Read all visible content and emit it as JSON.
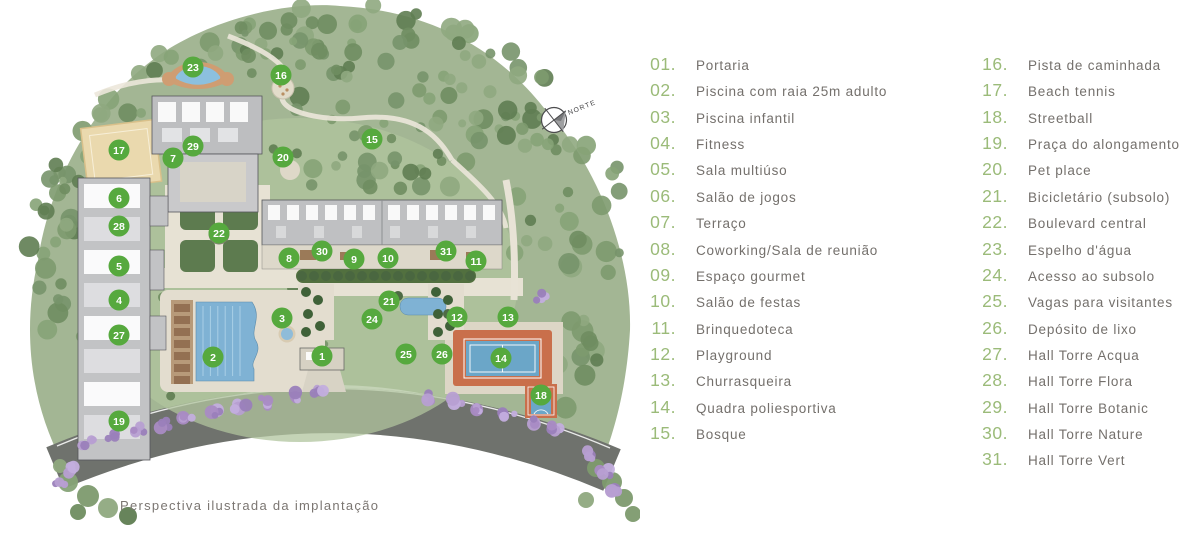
{
  "map": {
    "caption": "Perspectiva ilustrada da implantação",
    "compass_label": "NORTE",
    "marker_color": "#56a93e",
    "markers": [
      {
        "n": "1",
        "x": 322,
        "y": 356
      },
      {
        "n": "2",
        "x": 213,
        "y": 357
      },
      {
        "n": "3",
        "x": 282,
        "y": 318
      },
      {
        "n": "4",
        "x": 119,
        "y": 300
      },
      {
        "n": "5",
        "x": 119,
        "y": 266
      },
      {
        "n": "6",
        "x": 119,
        "y": 198
      },
      {
        "n": "7",
        "x": 173,
        "y": 158
      },
      {
        "n": "8",
        "x": 289,
        "y": 258
      },
      {
        "n": "9",
        "x": 354,
        "y": 259
      },
      {
        "n": "10",
        "x": 388,
        "y": 258
      },
      {
        "n": "11",
        "x": 476,
        "y": 261
      },
      {
        "n": "12",
        "x": 457,
        "y": 317
      },
      {
        "n": "13",
        "x": 508,
        "y": 317
      },
      {
        "n": "14",
        "x": 501,
        "y": 358
      },
      {
        "n": "15",
        "x": 372,
        "y": 139
      },
      {
        "n": "16",
        "x": 281,
        "y": 75
      },
      {
        "n": "17",
        "x": 119,
        "y": 150
      },
      {
        "n": "18",
        "x": 541,
        "y": 395
      },
      {
        "n": "19",
        "x": 119,
        "y": 421
      },
      {
        "n": "20",
        "x": 283,
        "y": 157
      },
      {
        "n": "21",
        "x": 389,
        "y": 301
      },
      {
        "n": "22",
        "x": 219,
        "y": 233
      },
      {
        "n": "23",
        "x": 193,
        "y": 67
      },
      {
        "n": "24",
        "x": 372,
        "y": 319
      },
      {
        "n": "25",
        "x": 406,
        "y": 354
      },
      {
        "n": "26",
        "x": 442,
        "y": 354
      },
      {
        "n": "27",
        "x": 119,
        "y": 335
      },
      {
        "n": "28",
        "x": 119,
        "y": 226
      },
      {
        "n": "29",
        "x": 193,
        "y": 146
      },
      {
        "n": "30",
        "x": 322,
        "y": 251
      },
      {
        "n": "31",
        "x": 446,
        "y": 251
      }
    ]
  },
  "legend": {
    "number_color": "#9bbb79",
    "text_color": "#74706c",
    "columns": [
      {
        "items": [
          {
            "num": "01.",
            "label": "Portaria"
          },
          {
            "num": "02.",
            "label": "Piscina com raia 25m adulto"
          },
          {
            "num": "03.",
            "label": "Piscina infantil"
          },
          {
            "num": "04.",
            "label": "Fitness"
          },
          {
            "num": "05.",
            "label": "Sala multiúso"
          },
          {
            "num": "06.",
            "label": "Salão de jogos"
          },
          {
            "num": "07.",
            "label": "Terraço"
          },
          {
            "num": "08.",
            "label": "Coworking/Sala de reunião"
          },
          {
            "num": "09.",
            "label": "Espaço gourmet"
          },
          {
            "num": "10.",
            "label": "Salão de festas"
          },
          {
            "num": "11.",
            "label": "Brinquedoteca"
          },
          {
            "num": "12.",
            "label": "Playground"
          },
          {
            "num": "13.",
            "label": "Churrasqueira"
          },
          {
            "num": "14.",
            "label": "Quadra poliesportiva"
          },
          {
            "num": "15.",
            "label": "Bosque"
          }
        ]
      },
      {
        "items": [
          {
            "num": "16.",
            "label": "Pista de caminhada"
          },
          {
            "num": "17.",
            "label": "Beach tennis"
          },
          {
            "num": "18.",
            "label": "Streetball"
          },
          {
            "num": "19.",
            "label": "Praça do alongamento"
          },
          {
            "num": "20.",
            "label": "Pet place"
          },
          {
            "num": "21.",
            "label": "Bicicletário (subsolo)"
          },
          {
            "num": "22.",
            "label": "Boulevard central"
          },
          {
            "num": "23.",
            "label": "Espelho d'água"
          },
          {
            "num": "24.",
            "label": "Acesso ao subsolo"
          },
          {
            "num": "25.",
            "label": "Vagas para visitantes"
          },
          {
            "num": "26.",
            "label": "Depósito de lixo"
          },
          {
            "num": "27.",
            "label": "Hall Torre Acqua"
          },
          {
            "num": "28.",
            "label": "Hall Torre Flora"
          },
          {
            "num": "29.",
            "label": "Hall Torre Botanic"
          },
          {
            "num": "30.",
            "label": "Hall Torre Nature"
          },
          {
            "num": "31.",
            "label": "Hall Torre Vert"
          }
        ]
      }
    ]
  },
  "palette": {
    "foliage_base": "#a3b694",
    "foliage_dark": "#5f7d52",
    "road_gray": "#6f726d",
    "pool_blue": "#7fb2d4",
    "court_orange": "#c96f4b",
    "court_blue": "#6ba6c8",
    "jacaranda_purple": "#a98bc4",
    "building_gray": "#c0c1c3",
    "sand_beige": "#ead9ae"
  }
}
